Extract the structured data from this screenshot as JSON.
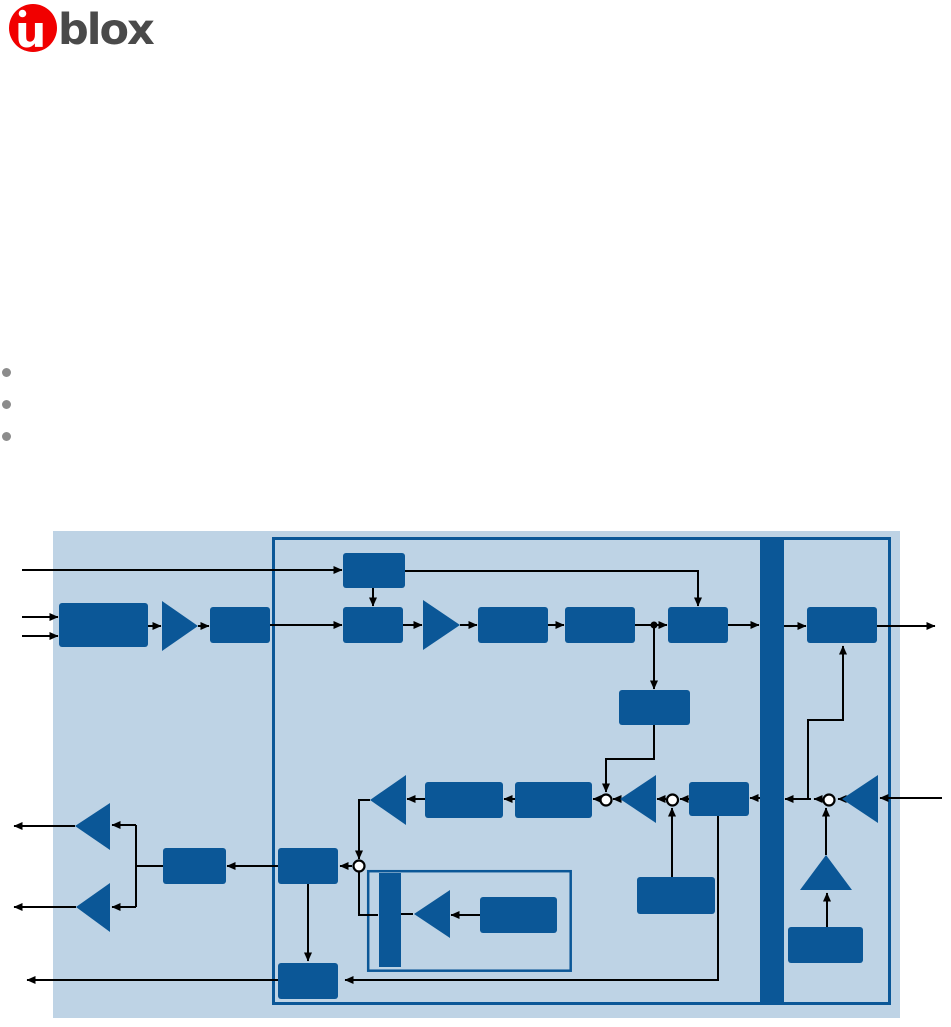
{
  "logo": {
    "u": "u",
    "brand": "blox"
  },
  "bullets": {
    "count": 3
  },
  "colors": {
    "page_bg": "#ffffff",
    "logo_red": "#f10000",
    "logo_text": "#4a4a4a",
    "bullet_gray": "#8c8c8c",
    "diagram_bg": "#bed3e5",
    "diagram_block": "#0b5797",
    "diagram_line": "#000000"
  }
}
